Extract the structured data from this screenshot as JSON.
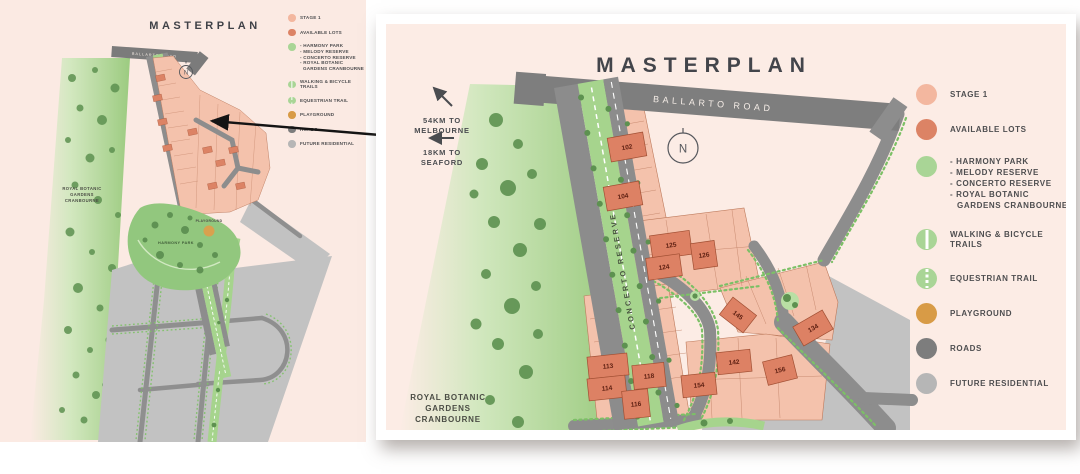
{
  "overview_panel": {
    "title": "MASTERPLAN",
    "map": {
      "ballarto_road": "BALLARTO ROAD",
      "royal_botanic_lines": [
        "ROYAL BOTANIC",
        "GARDENS",
        "CRANBOURNE"
      ],
      "harmony_park": "HARMONY PARK",
      "playground": "PLAYGROUND",
      "compass": "N"
    }
  },
  "detail_panel": {
    "title": "MASTERPLAN",
    "compass": "N",
    "distances": {
      "melbourne_lines": [
        "54KM TO",
        "MELBOURNE"
      ],
      "seaford_lines": [
        "18KM TO",
        "SEAFORD"
      ]
    },
    "map": {
      "ballarto_road": "BALLARTO ROAD",
      "concerto_reserve": "CONCERTO RESERVE",
      "royal_botanic_lines": [
        "ROYAL BOTANIC",
        "GARDENS",
        "CRANBOURNE"
      ]
    },
    "lots": [
      "102",
      "104",
      "125",
      "124",
      "126",
      "145",
      "134",
      "113",
      "118",
      "114",
      "116",
      "154",
      "142",
      "156"
    ]
  },
  "legend": {
    "items": [
      {
        "label": "STAGE 1",
        "color": "#f3b79f"
      },
      {
        "label": "AVAILABLE LOTS",
        "color": "#dc8365"
      },
      {
        "color": "#a9d596",
        "lines": [
          "- HARMONY PARK",
          "- MELODY RESERVE",
          "- CONCERTO RESERVE",
          "- ROYAL BOTANIC",
          "GARDENS CRANBOURNE"
        ]
      },
      {
        "label": "WALKING & BICYCLE TRAILS",
        "color": "#a9d596",
        "stripe": "solid"
      },
      {
        "label": "EQUESTRIAN TRAIL",
        "color": "#a9d596",
        "stripe": "dashed"
      },
      {
        "label": "PLAYGROUND",
        "color": "#d89b46"
      },
      {
        "label": "ROADS",
        "color": "#7d7d7d"
      },
      {
        "label": "FUTURE RESIDENTIAL",
        "color": "#b6b6b6"
      }
    ]
  },
  "colors": {
    "background": "#ffffff",
    "panel_pink": "#fbeae3",
    "stage1_lot": "#f4c2ac",
    "available_lot": "#dc8365",
    "road_gray": "#8c8c8c",
    "future_residential": "#c2c2c2",
    "reserve_green": "#a6d48d",
    "tree_green": "#5d9150",
    "playground_tan": "#d89b46",
    "title_text": "#43454b"
  }
}
